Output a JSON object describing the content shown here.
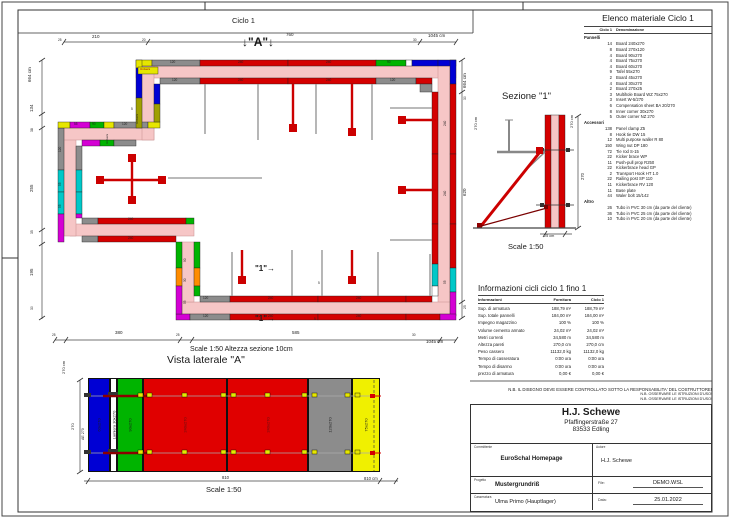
{
  "plan": {
    "title": "Ciclo 1",
    "marker_a": "↓\"A\"↓",
    "scale_note": "Scale 1:50   Altezza sezione 10cm"
  },
  "elevation": {
    "title": "Vista laterale \"A\"",
    "scale": "Scale 1:50",
    "panels": [
      {
        "label": "60x270",
        "color": "#0000d4",
        "w": 22
      },
      {
        "label": "Lamiera 30x270",
        "color": "#ffffff",
        "w": 7
      },
      {
        "label": "90x270",
        "color": "#00b400",
        "w": 26
      },
      {
        "label": "240x270",
        "color": "#e00000",
        "w": 84,
        "lc": "#5c1212"
      },
      {
        "label": "240x270",
        "color": "#e00000",
        "w": 81,
        "lc": "#5c1212"
      },
      {
        "label": "120x270",
        "color": "#8c8c8c",
        "w": 44
      },
      {
        "label": "75x270",
        "color": "#f0f000",
        "w": 28
      }
    ]
  },
  "section": {
    "title": "Sezione \"1\"",
    "scale": "Scale 1:50"
  },
  "material_list": {
    "title": "Elenco materiale  Ciclo 1",
    "col_qty": "Ciclo 1",
    "col_name": "Denominazione",
    "sections": [
      {
        "group": "Pannelli",
        "items": [
          [
            14,
            "Board 240x270"
          ],
          [
            8,
            "Board 270x120"
          ],
          [
            4,
            "Board 90x270"
          ],
          [
            4,
            "Board 75x270"
          ],
          [
            4,
            "Board 60x270"
          ],
          [
            9,
            "Tafel 55x270"
          ],
          [
            2,
            "Board 45x270"
          ],
          [
            4,
            "Board 30x270"
          ],
          [
            2,
            "Board 270x25"
          ],
          [
            3,
            "Multihole Board WZ 75x270"
          ],
          [
            3,
            "Insert W-5/270"
          ],
          [
            6,
            "Compensation sheet BA 20/270"
          ],
          [
            8,
            "Inner corner 30x270"
          ],
          [
            5,
            "Outer corner NZ 270"
          ]
        ]
      },
      {
        "group": "Accessori",
        "items": [
          [
            138,
            "Panel clamp Z5"
          ],
          [
            8,
            "Hook tie DW 15"
          ],
          [
            12,
            "Multi purpose waller R 80"
          ],
          [
            150,
            "Wing nut DP 180"
          ],
          [
            72,
            "Tie rod S-15"
          ],
          [
            22,
            "Kicker brace WP"
          ],
          [
            11,
            "Push-pull prop R250"
          ],
          [
            22,
            "Kickerbrace head GP"
          ],
          [
            2,
            "Transport Hook HT 1.0"
          ],
          [
            22,
            "Railing post SP 110"
          ],
          [
            11,
            "Kickerbrace RV 120"
          ],
          [
            11,
            "Base plate"
          ],
          [
            44,
            "Waler bolt 15/142"
          ]
        ]
      },
      {
        "group": "Altro",
        "items": [
          [
            26,
            "Tubo in PVC 30 cm (da parte del cliente)"
          ],
          [
            36,
            "Tubo in PVC 25 cm (da parte del cliente)"
          ],
          [
            10,
            "Tubo in PVC 20 cm (da parte del cliente)"
          ]
        ]
      }
    ]
  },
  "info_table": {
    "title": "Informazioni cicli  ciclo 1 fino 1",
    "col_info": "Informazioni",
    "col_forn": "Fornitura",
    "col_ciclo": "Ciclo 1",
    "rows": [
      [
        "Sup. di armatura",
        "188,79 m²",
        "188,79 m²"
      ],
      [
        "Sup. totale pannelli",
        "184,00 m²",
        "184,00 m²"
      ],
      [
        "Impegno magazzino",
        "100 %",
        "100 %"
      ],
      [
        "Volume cemento armato",
        "24,02 m³",
        "24,02 m³"
      ],
      [
        "Metri correnti",
        "34,580 m",
        "34,580 m"
      ],
      [
        "Altezza pareti",
        "270,0 cm",
        "270,0 cm"
      ],
      [
        "Peso cassero",
        "11132,0 kg",
        "11132,0 kg"
      ],
      [
        "Tempo di casseratura",
        "0:00 ora",
        "0:00 ora"
      ],
      [
        "Tempo di disarmo",
        "0:00 ora",
        "0:00 ora"
      ],
      [
        "prezzo di armatura",
        "0,00 €",
        "0,00 €"
      ]
    ]
  },
  "notes": [
    "N.B. IL DISEGNO DEVE ESSERE CONTROLLATO SOTTO LA RESPONSABILITA' DEL COSTRUTTORE!",
    "N.B. OSSERVARE LE ISTRUZIONI D'USO!",
    "N.B. OSSERVARE LE ISTRUZIONI D'USO!"
  ],
  "title_block": {
    "company": "H.J. Schewe",
    "address1": "Pfaffingerstraße 27",
    "address2": "83533 Edling",
    "committente_label": "Committente",
    "committente": "EuroSchal Homepage",
    "autore_label": "Autore",
    "autore": "H.J. Schewe",
    "progetto_label": "Progetto",
    "progetto": "Mustergrundriß",
    "file_label": "File:",
    "file": "DEMO.WSL",
    "casseratura_label": "Casseratura",
    "casseratura": "Ulma Primo (Hauptlager)",
    "data_label": "Data:",
    "data": "25.01.2022"
  },
  "free_labels": {
    "plan_dims": [
      {
        "t": "210",
        "x": 92,
        "y": 35,
        "s": 4.5
      },
      {
        "t": "760",
        "x": 286,
        "y": 33,
        "s": 4.5
      },
      {
        "t": "1045 cm",
        "x": 428,
        "y": 34,
        "s": 4.5
      },
      {
        "t": "25",
        "x": 58,
        "y": 39,
        "s": 3.2
      },
      {
        "t": "20",
        "x": 142,
        "y": 39,
        "s": 3.2
      },
      {
        "t": "30",
        "x": 413,
        "y": 39,
        "s": 3.2
      },
      {
        "t": "664 cm",
        "x": 28,
        "y": 82,
        "s": 4.5,
        "r": 1
      },
      {
        "t": "134",
        "x": 30,
        "y": 112,
        "s": 4.5,
        "r": 1
      },
      {
        "t": "38",
        "x": 31,
        "y": 132,
        "s": 3.4,
        "r": 1
      },
      {
        "t": "255",
        "x": 30,
        "y": 192,
        "s": 4.5,
        "r": 1
      },
      {
        "t": "35",
        "x": 31,
        "y": 234,
        "s": 3.4,
        "r": 1
      },
      {
        "t": "195",
        "x": 30,
        "y": 276,
        "s": 4.5,
        "r": 1
      },
      {
        "t": "30",
        "x": 31,
        "y": 310,
        "s": 3.4,
        "r": 1
      },
      {
        "t": "664 cm",
        "x": 463,
        "y": 88,
        "s": 4.5,
        "r": 1
      },
      {
        "t": "30",
        "x": 464,
        "y": 100,
        "s": 3.4,
        "r": 1
      },
      {
        "t": "620",
        "x": 463,
        "y": 196,
        "s": 4.5,
        "r": 1
      },
      {
        "t": "25",
        "x": 464,
        "y": 309,
        "s": 3.4,
        "r": 1
      },
      {
        "t": "25",
        "x": 52,
        "y": 334,
        "s": 3.2
      },
      {
        "t": "380",
        "x": 115,
        "y": 331,
        "s": 4.5
      },
      {
        "t": "25",
        "x": 176,
        "y": 334,
        "s": 3.2
      },
      {
        "t": "585",
        "x": 292,
        "y": 331,
        "s": 4.5
      },
      {
        "t": "30",
        "x": 412,
        "y": 334,
        "s": 3.2
      },
      {
        "t": "1045 cm",
        "x": 426,
        "y": 340,
        "s": 4.5
      },
      {
        "t": "\"1\"→",
        "x": 255,
        "y": 265,
        "s": 8,
        "b": 1
      },
      {
        "t": "\"1\"→",
        "x": 255,
        "y": 315,
        "s": 8,
        "b": 1
      },
      {
        "t": "5",
        "x": 318,
        "y": 282,
        "s": 3.2
      },
      {
        "t": "5",
        "x": 314,
        "y": 318,
        "s": 3.2
      },
      {
        "t": "5",
        "x": 131,
        "y": 108,
        "s": 3.2
      },
      {
        "t": "Univers",
        "x": 140,
        "y": 68,
        "s": 3,
        "c": "#a00000"
      },
      {
        "t": "Univers",
        "x": 136,
        "y": 124,
        "s": 3,
        "r": 1
      },
      {
        "t": "Univers",
        "x": 106,
        "y": 144,
        "s": 3,
        "r": 1
      }
    ],
    "plan_panels": [
      {
        "t": "120",
        "x": 170,
        "y": 61,
        "s": 3.2
      },
      {
        "t": "240",
        "x": 238,
        "y": 61,
        "s": 3.2
      },
      {
        "t": "240",
        "x": 326,
        "y": 61,
        "s": 3.2
      },
      {
        "t": "90",
        "x": 387,
        "y": 61,
        "s": 3.2
      },
      {
        "t": "120",
        "x": 172,
        "y": 79,
        "s": 3.2
      },
      {
        "t": "240",
        "x": 238,
        "y": 79,
        "s": 3.2
      },
      {
        "t": "240",
        "x": 326,
        "y": 79,
        "s": 3.2
      },
      {
        "t": "120",
        "x": 390,
        "y": 79,
        "s": 3.2
      },
      {
        "t": "120",
        "x": 203,
        "y": 297,
        "s": 3.2
      },
      {
        "t": "240",
        "x": 268,
        "y": 297,
        "s": 3.2
      },
      {
        "t": "240",
        "x": 356,
        "y": 297,
        "s": 3.2
      },
      {
        "t": "120",
        "x": 203,
        "y": 315,
        "s": 3.2
      },
      {
        "t": "240",
        "x": 268,
        "y": 315,
        "s": 3.2
      },
      {
        "t": "240",
        "x": 356,
        "y": 315,
        "s": 3.2
      },
      {
        "t": "240",
        "x": 128,
        "y": 218,
        "s": 3.2
      },
      {
        "t": "240",
        "x": 128,
        "y": 237,
        "s": 3.2
      },
      {
        "t": "120",
        "x": 59,
        "y": 152,
        "s": 3.2,
        "r": 1
      },
      {
        "t": "55",
        "x": 59,
        "y": 186,
        "s": 3.2,
        "r": 1
      },
      {
        "t": "55",
        "x": 59,
        "y": 208,
        "s": 3.2,
        "r": 1
      },
      {
        "t": "240",
        "x": 444,
        "y": 126,
        "s": 3.2,
        "r": 1
      },
      {
        "t": "240",
        "x": 444,
        "y": 196,
        "s": 3.2,
        "r": 1
      },
      {
        "t": "55",
        "x": 444,
        "y": 284,
        "s": 3.2,
        "r": 1
      },
      {
        "t": "90",
        "x": 184,
        "y": 262,
        "s": 3.2,
        "r": 1
      },
      {
        "t": "30",
        "x": 184,
        "y": 282,
        "s": 3.2,
        "r": 1
      },
      {
        "t": "55",
        "x": 184,
        "y": 304,
        "s": 3.2,
        "r": 1
      },
      {
        "t": "55",
        "x": 74,
        "y": 123,
        "s": 3.2
      },
      {
        "t": "90",
        "x": 92,
        "y": 123,
        "s": 3.2
      },
      {
        "t": "120",
        "x": 122,
        "y": 123,
        "s": 3.2
      }
    ],
    "elevation_dims": [
      {
        "t": "270 cm",
        "x": 62,
        "y": 374,
        "s": 4,
        "r": 1
      },
      {
        "t": "270",
        "x": 71,
        "y": 430,
        "s": 4,
        "r": 1
      },
      {
        "t": "AE 270",
        "x": 82,
        "y": 440,
        "s": 3.6,
        "r": 1
      },
      {
        "t": "810",
        "x": 222,
        "y": 476,
        "s": 4.2
      },
      {
        "t": "810 cm",
        "x": 364,
        "y": 477,
        "s": 4.2
      }
    ],
    "section_dims": [
      {
        "t": "270 cm",
        "x": 474,
        "y": 130,
        "s": 4,
        "r": 1
      },
      {
        "t": "270 cm",
        "x": 570,
        "y": 128,
        "s": 4,
        "r": 1
      },
      {
        "t": "270",
        "x": 581,
        "y": 180,
        "s": 4.2,
        "r": 1
      },
      {
        "t": "25 cm",
        "x": 544,
        "y": 235,
        "s": 3.8
      }
    ]
  }
}
